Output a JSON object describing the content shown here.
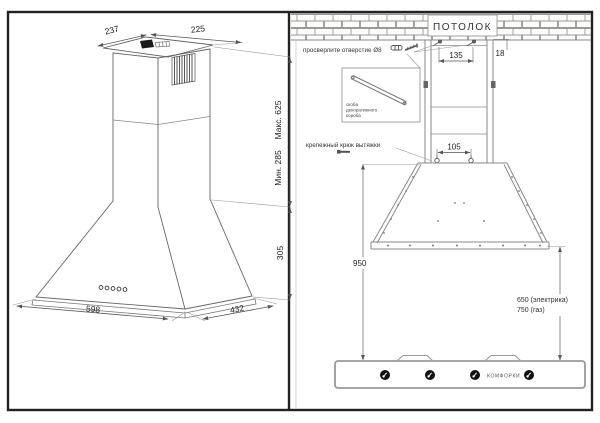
{
  "left_panel": {
    "dims": {
      "top_width_back": "237",
      "top_width_right": "225",
      "height_max": "Макс. 625",
      "height_min": "Мин. 285",
      "dome_height": "305",
      "front_width": "598",
      "side_depth": "432"
    }
  },
  "right_panel": {
    "ceiling_label": "ПОТОЛОК",
    "drill_label": "просверлите отверстие Ø8",
    "bracket_caption": [
      "скоба",
      "декоративного",
      "короба"
    ],
    "hook_label": "крепежный крюк вытяжки",
    "dims": {
      "screw_spacing": "135",
      "ceiling_offset": "18",
      "hook_spacing": "105",
      "hook_to_hob": "950",
      "clearance_electric": "650 (электрика)",
      "clearance_gas": "750 (газ)"
    },
    "hob_label": "КОМФОРКИ"
  },
  "colors": {
    "line_dark": "#555555",
    "line_light": "#999999",
    "border": "#222222",
    "knob": "#111111"
  }
}
